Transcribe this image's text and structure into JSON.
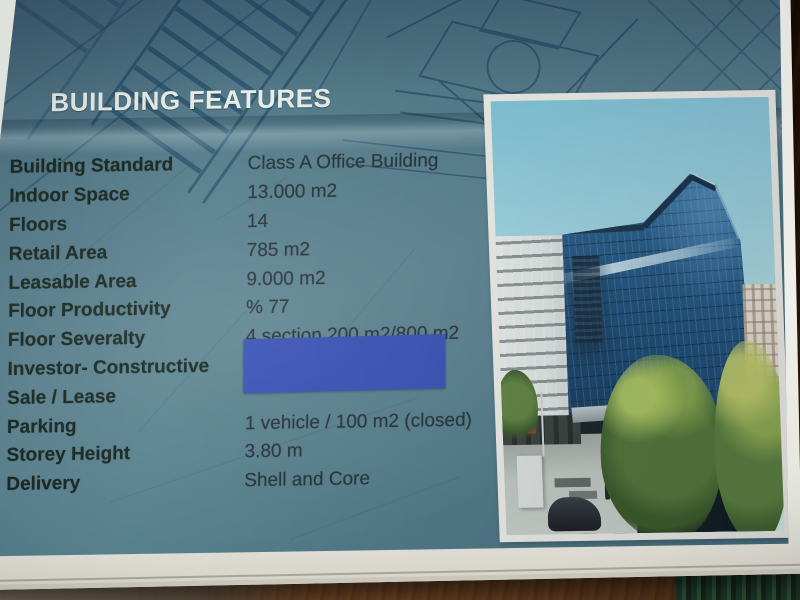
{
  "scene": {
    "description": "Photograph of a printed building-features brochure page lying on a wooden table",
    "colors": {
      "page_teal": "#57808d",
      "blueprint_line": "#1d4060",
      "title_text": "#e9eee8",
      "label_text": "#17271f",
      "value_text": "#27323a",
      "redaction_blue": "#3750b6",
      "paper_white": "#efefeb",
      "wood_dark": "#241309"
    }
  },
  "document": {
    "title": "BUILDING FEATURES",
    "rows": [
      {
        "label": "Building Standard",
        "value": "Class A Office Building"
      },
      {
        "label": "Indoor Space",
        "value": "13.000 m2"
      },
      {
        "label": "Floors",
        "value": "14"
      },
      {
        "label": "Retail Area",
        "value": "785 m2"
      },
      {
        "label": "Leasable Area",
        "value": "9.000 m2"
      },
      {
        "label": "Floor Productivity",
        "value": "% 77"
      },
      {
        "label": "Floor Severalty",
        "value": "4 section 200 m2/800 m2"
      },
      {
        "label": "Investor- Constructive",
        "value": ""
      },
      {
        "label": "Sale / Lease",
        "value": ""
      },
      {
        "label": "Parking",
        "value": "1 vehicle / 100 m2 (closed)"
      },
      {
        "label": "Storey Height",
        "value": "3.80 m"
      },
      {
        "label": "Delivery",
        "value": "Shell and Core"
      }
    ],
    "photo_alt": "Blue glass office tower photographed from street level with white and cream neighboring buildings, green trees and a plaza with a parked car"
  }
}
